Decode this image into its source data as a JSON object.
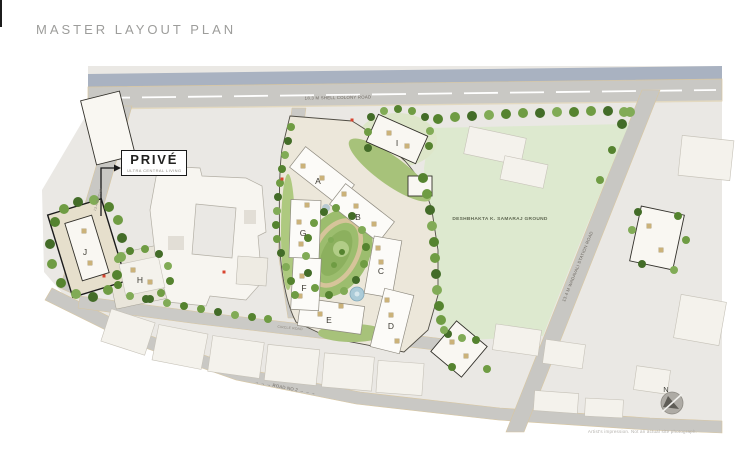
{
  "page": {
    "title": "MASTER LAYOUT PLAN",
    "disclaimer": "Artist's impression. Not an actual site photograph."
  },
  "prive": {
    "name": "PRIVÉ",
    "subtitle": "ULTRA CENTRAL LIVING"
  },
  "roads": {
    "top": "18.3 M SHELL COLONY ROAD",
    "left": "13.4 M ROAD",
    "right": "13.4 M WADAVALI STATION ROAD",
    "middle": "CIRCLE ROAD",
    "bottom": "→ → →   ROAD NO 2   → → →"
  },
  "ground": {
    "label": "DESHBHAKTA K. SAMARAJ GROUND"
  },
  "buildings": {
    "a": "A",
    "b": "B",
    "c": "C",
    "d": "D",
    "e": "E",
    "f": "F",
    "g": "G",
    "h": "H",
    "i": "I",
    "j": "J"
  },
  "compass": {
    "north": "N"
  },
  "colors": {
    "map_base": "#eae8e4",
    "road": "#c9c8c4",
    "road_edge": "#d8c6a0",
    "median_strip": "#a9b2c1",
    "ground_green": "#dde9cf",
    "tree_green": "#55832f",
    "building_white": "#fbfaf7",
    "outline_dark": "#1a1a1a",
    "water_blue": "#abcbd8",
    "marker_red": "#d8442f"
  }
}
